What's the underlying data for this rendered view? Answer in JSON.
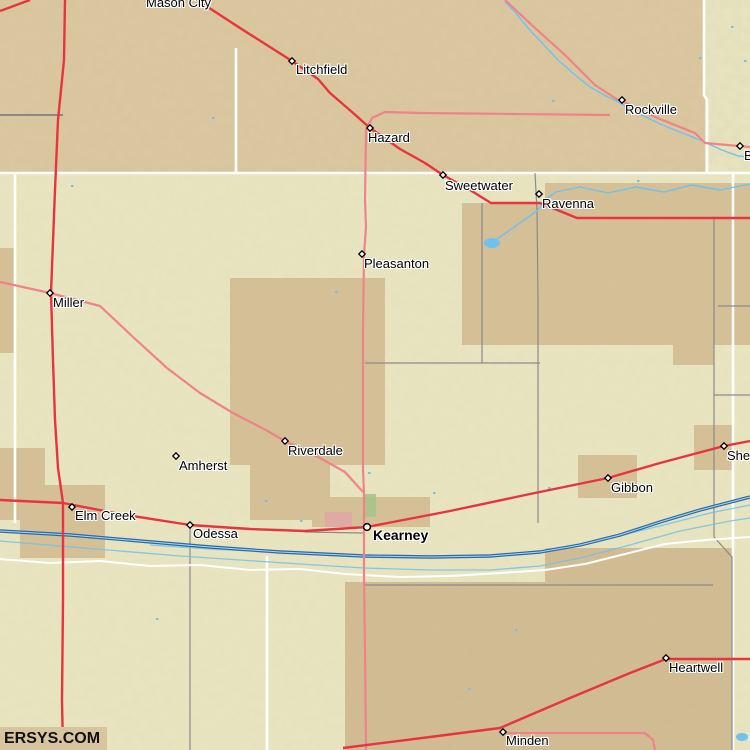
{
  "watermark": "ERSYS.COM",
  "colors": {
    "base_south": "#e8e5c0",
    "base_north": "#dcc8a0",
    "patch_tan": "#d5c097",
    "patch_tan_dark": "#d2bc93",
    "urban_pink": "#dfa9a5",
    "urban_green": "#a9c48e",
    "road_red": "#e73440",
    "road_pink": "#f0828a",
    "river_dark": "#2a69a8",
    "river_light": "#a8d8f2",
    "stream_blue": "#6fc2ef",
    "boundary_white": "#ffffff",
    "boundary_gray": "#8b8b8b",
    "boundary_darkgray": "#5d6570"
  },
  "towns": [
    {
      "name": "Mason City",
      "label_x": 146,
      "label_y": -4,
      "marker": "none"
    },
    {
      "name": "Litchfield",
      "label_x": 296,
      "label_y": 63,
      "marker": "diamond",
      "mx": 292,
      "my": 61
    },
    {
      "name": "Hazard",
      "label_x": 368,
      "label_y": 131,
      "marker": "diamond",
      "mx": 370,
      "my": 128
    },
    {
      "name": "Rockville",
      "label_x": 625,
      "label_y": 103,
      "marker": "diamond",
      "mx": 622,
      "my": 100
    },
    {
      "name": "Sweetwater",
      "label_x": 445,
      "label_y": 179,
      "marker": "diamond",
      "mx": 443,
      "my": 175
    },
    {
      "name": "Ravenna",
      "label_x": 542,
      "label_y": 197,
      "marker": "diamond",
      "mx": 539,
      "my": 194
    },
    {
      "name": "Boelus",
      "label_x": 744,
      "label_y": 149,
      "marker": "diamond",
      "mx": 740,
      "my": 146
    },
    {
      "name": "Pleasanton",
      "label_x": 364,
      "label_y": 257,
      "marker": "diamond",
      "mx": 362,
      "my": 254
    },
    {
      "name": "Miller",
      "label_x": 53,
      "label_y": 296,
      "marker": "diamond",
      "mx": 50,
      "my": 293
    },
    {
      "name": "Riverdale",
      "label_x": 288,
      "label_y": 444,
      "marker": "diamond",
      "mx": 285,
      "my": 441
    },
    {
      "name": "Amherst",
      "label_x": 179,
      "label_y": 459,
      "marker": "diamond",
      "mx": 176,
      "my": 456
    },
    {
      "name": "Gibbon",
      "label_x": 611,
      "label_y": 481,
      "marker": "diamond",
      "mx": 608,
      "my": 478
    },
    {
      "name": "Shelton",
      "label_x": 727,
      "label_y": 449,
      "marker": "diamond",
      "mx": 724,
      "my": 446
    },
    {
      "name": "Elm Creek",
      "label_x": 75,
      "label_y": 509,
      "marker": "diamond",
      "mx": 72,
      "my": 507
    },
    {
      "name": "Odessa",
      "label_x": 193,
      "label_y": 527,
      "marker": "diamond",
      "mx": 190,
      "my": 525
    },
    {
      "name": "Kearney",
      "label_x": 373,
      "label_y": 529,
      "marker": "circle",
      "mx": 367,
      "my": 527,
      "bold": true
    },
    {
      "name": "Heartwell",
      "label_x": 669,
      "label_y": 661,
      "marker": "diamond",
      "mx": 666,
      "my": 658
    },
    {
      "name": "Minden",
      "label_x": 506,
      "label_y": 734,
      "marker": "diamond",
      "mx": 503,
      "my": 732
    }
  ],
  "terrain": {
    "north_band": [
      0,
      0,
      750,
      173
    ],
    "northeast_khaki": [
      705,
      0,
      45,
      173
    ],
    "patches": [
      [
        230,
        278,
        155,
        187
      ],
      [
        250,
        465,
        80,
        55
      ],
      [
        545,
        183,
        205,
        162
      ],
      [
        462,
        203,
        83,
        142
      ],
      [
        673,
        345,
        41,
        20
      ],
      [
        20,
        485,
        85,
        73
      ],
      [
        0,
        248,
        15,
        105
      ],
      [
        0,
        448,
        45,
        72
      ],
      [
        345,
        582,
        387,
        168
      ],
      [
        545,
        548,
        187,
        36
      ],
      [
        578,
        455,
        59,
        43
      ],
      [
        694,
        425,
        39,
        45
      ],
      [
        312,
        497,
        118,
        30
      ]
    ],
    "urban": [
      {
        "rect": [
          325,
          512,
          27,
          15
        ],
        "color": "urban_pink"
      },
      {
        "rect": [
          363,
          494,
          13,
          23
        ],
        "color": "urban_green"
      }
    ]
  },
  "boundaries": {
    "white": [
      [
        [
          0,
          173
        ],
        [
          750,
          173
        ]
      ],
      [
        [
          236,
          48
        ],
        [
          236,
          173
        ]
      ],
      [
        [
          704,
          0
        ],
        [
          704,
          95
        ],
        [
          707,
          100
        ],
        [
          707,
          173
        ]
      ],
      [
        [
          15,
          173
        ],
        [
          15,
          523
        ]
      ],
      [
        [
          267,
          556
        ],
        [
          267,
          750
        ]
      ],
      [
        [
          733,
          173
        ],
        [
          733,
          750
        ]
      ]
    ],
    "gray": [
      [
        [
          535,
          173
        ],
        [
          537,
          210
        ],
        [
          538,
          300
        ],
        [
          538,
          523
        ]
      ],
      [
        [
          482,
          203
        ],
        [
          482,
          363
        ]
      ],
      [
        [
          365,
          363
        ],
        [
          540,
          363
        ]
      ],
      [
        [
          714,
          219
        ],
        [
          714,
          537
        ],
        [
          732,
          557
        ],
        [
          732,
          750
        ]
      ],
      [
        [
          714,
          395
        ],
        [
          750,
          395
        ]
      ],
      [
        [
          718,
          306
        ],
        [
          750,
          306
        ]
      ],
      [
        [
          365,
          585
        ],
        [
          713,
          585
        ]
      ],
      [
        [
          190,
          527
        ],
        [
          190,
          750
        ]
      ],
      [
        [
          305,
          532
        ],
        [
          363,
          533
        ]
      ]
    ],
    "darkgray": [
      [
        [
          0,
          115
        ],
        [
          63,
          115
        ]
      ]
    ]
  },
  "water": {
    "streams": [
      [
        [
          505,
          2
        ],
        [
          515,
          12
        ],
        [
          528,
          28
        ],
        [
          543,
          44
        ],
        [
          558,
          60
        ],
        [
          574,
          74
        ],
        [
          590,
          87
        ],
        [
          608,
          97
        ],
        [
          622,
          104
        ],
        [
          640,
          114
        ],
        [
          660,
          124
        ],
        [
          680,
          132
        ],
        [
          700,
          140
        ],
        [
          722,
          150
        ],
        [
          738,
          156
        ],
        [
          750,
          157
        ]
      ],
      [
        [
          750,
          184
        ],
        [
          720,
          190
        ],
        [
          692,
          185
        ],
        [
          664,
          192
        ],
        [
          636,
          187
        ],
        [
          608,
          193
        ],
        [
          580,
          187
        ],
        [
          556,
          192
        ],
        [
          545,
          200
        ],
        [
          538,
          210
        ],
        [
          527,
          218
        ],
        [
          513,
          228
        ],
        [
          500,
          237
        ],
        [
          490,
          245
        ]
      ]
    ],
    "platte_main": [
      [
        0,
        531
      ],
      [
        70,
        535
      ],
      [
        140,
        541
      ],
      [
        210,
        547
      ],
      [
        280,
        552
      ],
      [
        364,
        556
      ],
      [
        430,
        557
      ],
      [
        490,
        556
      ],
      [
        540,
        552
      ],
      [
        580,
        545
      ],
      [
        620,
        535
      ],
      [
        660,
        522
      ],
      [
        700,
        510
      ],
      [
        750,
        497
      ]
    ],
    "platte_white": [
      [
        0,
        559
      ],
      [
        50,
        563
      ],
      [
        100,
        561
      ],
      [
        150,
        566
      ],
      [
        200,
        565
      ],
      [
        250,
        570
      ],
      [
        300,
        569
      ],
      [
        345,
        574
      ],
      [
        400,
        577
      ],
      [
        450,
        576
      ],
      [
        500,
        573
      ],
      [
        545,
        570
      ],
      [
        585,
        564
      ],
      [
        625,
        554
      ],
      [
        665,
        544
      ],
      [
        705,
        540
      ],
      [
        750,
        537
      ]
    ],
    "braids": [
      [
        [
          0,
          541
        ],
        [
          60,
          546
        ],
        [
          120,
          551
        ],
        [
          180,
          556
        ],
        [
          240,
          560
        ],
        [
          300,
          564
        ],
        [
          364,
          568
        ],
        [
          430,
          570
        ],
        [
          490,
          570
        ],
        [
          540,
          566
        ],
        [
          580,
          558
        ],
        [
          630,
          545
        ],
        [
          680,
          531
        ],
        [
          730,
          521
        ],
        [
          750,
          518
        ]
      ],
      [
        [
          150,
          545
        ],
        [
          210,
          549
        ],
        [
          270,
          552
        ],
        [
          330,
          554
        ]
      ],
      [
        [
          560,
          548
        ],
        [
          610,
          538
        ],
        [
          660,
          526
        ],
        [
          710,
          513
        ],
        [
          750,
          505
        ]
      ]
    ],
    "ponds": [
      {
        "cx": 492,
        "cy": 243,
        "rx": 8,
        "ry": 5
      },
      {
        "cx": 742,
        "cy": 737,
        "rx": 6,
        "ry": 4
      }
    ],
    "specks": [
      [
        212,
        117
      ],
      [
        71,
        185
      ],
      [
        335,
        291
      ],
      [
        433,
        492
      ],
      [
        548,
        487
      ],
      [
        515,
        629
      ],
      [
        156,
        618
      ],
      [
        468,
        688
      ],
      [
        731,
        26
      ],
      [
        699,
        57
      ],
      [
        744,
        60
      ],
      [
        637,
        180
      ],
      [
        552,
        100
      ],
      [
        368,
        472
      ],
      [
        300,
        520
      ],
      [
        265,
        500
      ]
    ]
  },
  "roads": {
    "primary": [
      [
        [
          0,
          11
        ],
        [
          30,
          0
        ]
      ],
      [
        [
          65,
          0
        ],
        [
          64,
          60
        ],
        [
          58,
          120
        ],
        [
          55,
          190
        ],
        [
          51,
          293
        ],
        [
          53,
          360
        ],
        [
          55,
          420
        ],
        [
          58,
          468
        ],
        [
          63,
          503
        ],
        [
          63,
          600
        ],
        [
          62,
          700
        ],
        [
          63,
          750
        ]
      ],
      [
        [
          197,
          0
        ],
        [
          240,
          28
        ],
        [
          292,
          61
        ],
        [
          318,
          79
        ],
        [
          330,
          93
        ],
        [
          352,
          112
        ],
        [
          370,
          128
        ],
        [
          400,
          149
        ],
        [
          425,
          163
        ],
        [
          443,
          175
        ],
        [
          470,
          190
        ],
        [
          491,
          203
        ],
        [
          540,
          203
        ],
        [
          577,
          218
        ],
        [
          750,
          218
        ]
      ],
      [
        [
          0,
          500
        ],
        [
          63,
          503
        ],
        [
          120,
          514
        ],
        [
          190,
          525
        ],
        [
          250,
          529
        ],
        [
          305,
          531
        ],
        [
          367,
          527
        ],
        [
          450,
          511
        ],
        [
          530,
          494
        ],
        [
          608,
          478
        ],
        [
          660,
          463
        ],
        [
          724,
          446
        ],
        [
          750,
          441
        ]
      ],
      [
        [
          343,
          748
        ],
        [
          430,
          737
        ],
        [
          500,
          728
        ],
        [
          570,
          698
        ],
        [
          630,
          673
        ],
        [
          666,
          659
        ],
        [
          750,
          659
        ]
      ]
    ],
    "secondary": [
      [
        [
          610,
          115
        ],
        [
          420,
          113
        ],
        [
          385,
          112
        ],
        [
          372,
          118
        ],
        [
          366,
          130
        ],
        [
          365,
          200
        ],
        [
          366,
          227
        ],
        [
          364,
          255
        ],
        [
          363,
          330
        ],
        [
          363,
          400
        ],
        [
          363,
          470
        ],
        [
          364,
          492
        ],
        [
          364,
          530
        ],
        [
          364,
          575
        ],
        [
          365,
          650
        ],
        [
          366,
          750
        ]
      ],
      [
        [
          505,
          0
        ],
        [
          535,
          28
        ],
        [
          565,
          55
        ],
        [
          595,
          85
        ],
        [
          618,
          100
        ]
      ],
      [
        [
          622,
          101
        ],
        [
          655,
          117
        ],
        [
          695,
          133
        ],
        [
          705,
          143
        ],
        [
          750,
          147
        ]
      ],
      [
        [
          0,
          282
        ],
        [
          50,
          293
        ],
        [
          100,
          306
        ],
        [
          133,
          337
        ],
        [
          167,
          368
        ],
        [
          200,
          393
        ],
        [
          233,
          413
        ],
        [
          262,
          428
        ],
        [
          285,
          441
        ],
        [
          320,
          458
        ],
        [
          345,
          472
        ],
        [
          363,
          492
        ]
      ],
      [
        [
          503,
          733
        ],
        [
          645,
          733
        ],
        [
          653,
          740
        ],
        [
          655,
          750
        ]
      ]
    ]
  }
}
